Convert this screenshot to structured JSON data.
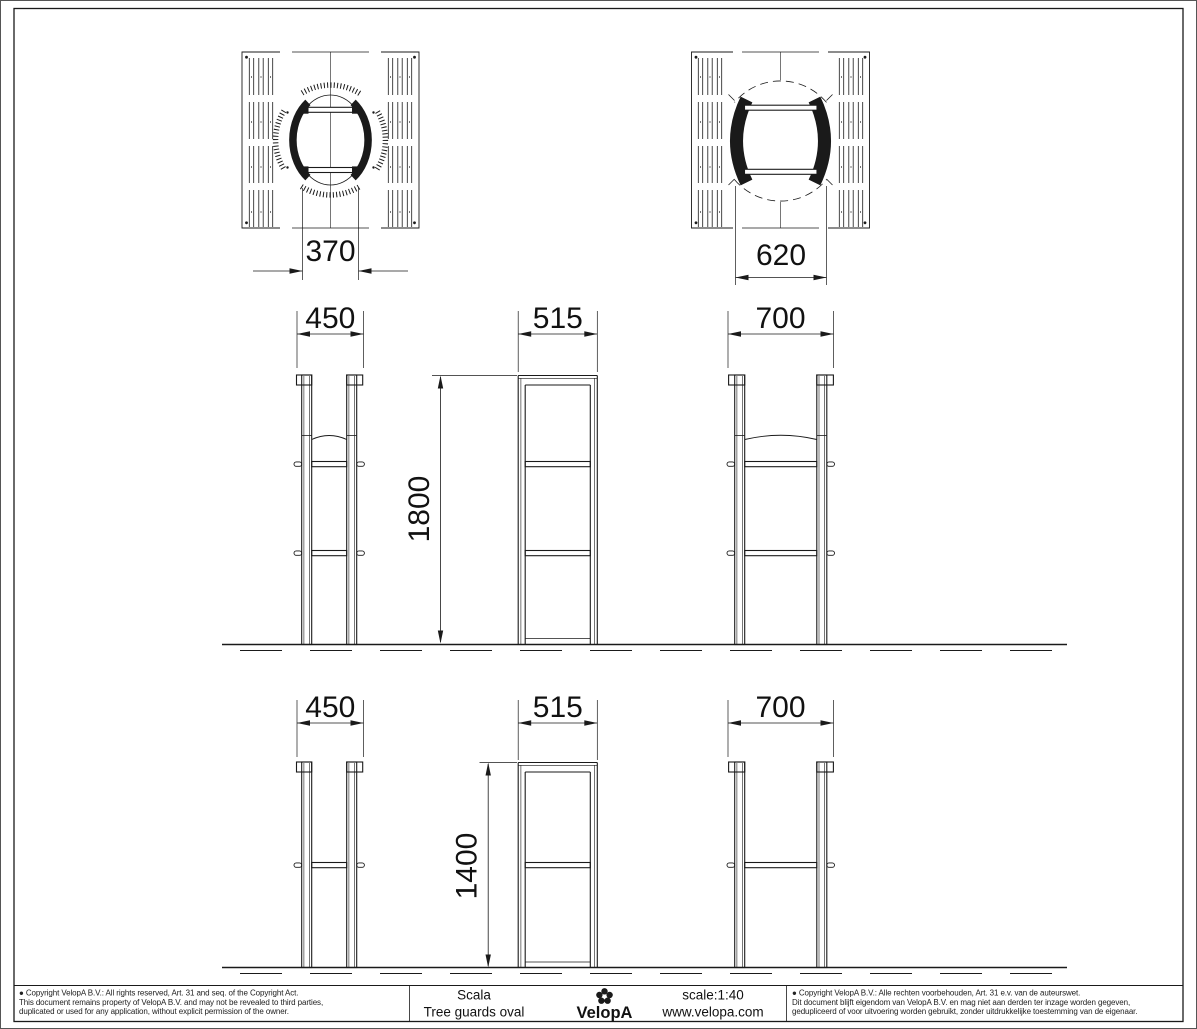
{
  "title_block": {
    "product_line": "Scala",
    "product_name": "Tree guards oval",
    "brand": "VelopA",
    "scale": "scale:1:40",
    "website": "www.velopa.com",
    "copyright_en_line1": "● Copyright VelopA B.V.: All rights reserved, Art. 31 and seq. of the Copyright Act.",
    "copyright_en_line2": "This document remains property of VelopA B.V. and may not be revealed to third parties,",
    "copyright_en_line3": "duplicated or used for any application, without explicit permission of the owner.",
    "copyright_nl_line1": "● Copyright VelopA B.V.: Alle rechten voorbehouden, Art. 31 e.v. van de auteurswet.",
    "copyright_nl_line2": "Dit document blijft eigendom van VelopA B.V. en mag niet aan derden ter inzage worden gegeven,",
    "copyright_nl_line3": "gedupliceerd of voor uitvoering worden gebruikt, zonder uitdrukkelijke toestemming van de eigenaar."
  },
  "dimensions": {
    "oval_small_width": "370",
    "oval_large_width": "620",
    "front_width_small": "450",
    "side_width": "515",
    "front_width_large": "700",
    "height_tall": "1800",
    "height_short": "1400"
  },
  "colors": {
    "line": "#1a1a1a",
    "background": "#ffffff"
  }
}
